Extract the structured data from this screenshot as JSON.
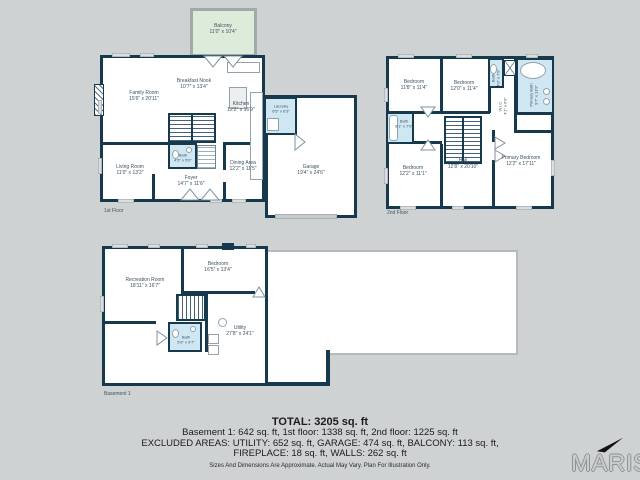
{
  "palette": {
    "background": "#cfd2d3",
    "wall_color": "#16394e",
    "bath_fill": "#cfe7f2",
    "balcony_fill": "#dcebda",
    "room_fill": "#ffffff"
  },
  "floors": {
    "first": {
      "caption": "1st Floor",
      "rooms": {
        "balcony": {
          "name": "Balcony",
          "dims": "11'0\" x 10'4\""
        },
        "family_room": {
          "name": "Family Room",
          "dims": "15'6\" x 20'11\""
        },
        "breakfast_nook": {
          "name": "Breakfast Nook",
          "dims": "10'7\" x 13'4\""
        },
        "kitchen": {
          "name": "Kitchen",
          "dims": "12'2\" x 16'9\""
        },
        "laundry": {
          "name": "Laundry",
          "dims": "6'5\" x 6'3\""
        },
        "bath": {
          "name": "Bath",
          "dims": "4'5\" x 5'0\""
        },
        "living_room": {
          "name": "Living Room",
          "dims": "11'0\" x 13'2\""
        },
        "foyer": {
          "name": "Foyer",
          "dims": "14'7\" x 11'6\""
        },
        "dining_area": {
          "name": "Dining Area",
          "dims": "12'2\" x 11'5\""
        },
        "garage": {
          "name": "Garage",
          "dims": "19'4\" x 24'6\""
        }
      }
    },
    "second": {
      "caption": "2nd Floor",
      "rooms": {
        "bedroom_top_left": {
          "name": "Bedroom",
          "dims": "11'8\" x 11'4\""
        },
        "bedroom_top_middle": {
          "name": "Bedroom",
          "dims": "12'0\" x 11'4\""
        },
        "bath_top": {
          "name": "Bath",
          "dims": "4'0\" x 7'0\""
        },
        "primary_bath": {
          "name": "Primary Bath",
          "dims": "9'7\" x 13'9\""
        },
        "wic": {
          "name": "W.I.C.",
          "dims": "4'1\" x 6'9\""
        },
        "bath_left": {
          "name": "Bath",
          "dims": "8'1\" x 7'0\""
        },
        "bedroom_bottom_left": {
          "name": "Bedroom",
          "dims": "12'2\" x 11'1\""
        },
        "hall": {
          "name": "Hall",
          "dims": "12'8\" x 20'10\""
        },
        "primary_bedroom": {
          "name": "Primary Bedroom",
          "dims": "12'2\" x 17'11\""
        }
      }
    },
    "basement": {
      "caption": "Basement 1",
      "rooms": {
        "recreation_room": {
          "name": "Recreation Room",
          "dims": "18'11\" x 16'7\""
        },
        "bedroom": {
          "name": "Bedroom",
          "dims": "16'5\" x 13'4\""
        },
        "bath": {
          "name": "Bath",
          "dims": "5'6\" x 9'7\""
        },
        "utility": {
          "name": "Utility",
          "dims": "27'8\" x 24'1\""
        }
      }
    }
  },
  "summary": {
    "total": "TOTAL: 3205 sq. ft",
    "line1": "Basement 1: 642 sq. ft, 1st floor: 1338 sq. ft, 2nd floor: 1225 sq. ft",
    "line2": "EXCLUDED AREAS: UTILITY: 652 sq. ft, GARAGE: 474 sq. ft, BALCONY: 113 sq. ft,",
    "line3": "FIREPLACE: 18 sq. ft, WALLS: 262 sq. ft",
    "disclaimer": "Sizes And Dimensions Are Approximate. Actual May Vary. Plan For Illustration Only."
  },
  "branding": {
    "logo_text": "MARIS"
  }
}
